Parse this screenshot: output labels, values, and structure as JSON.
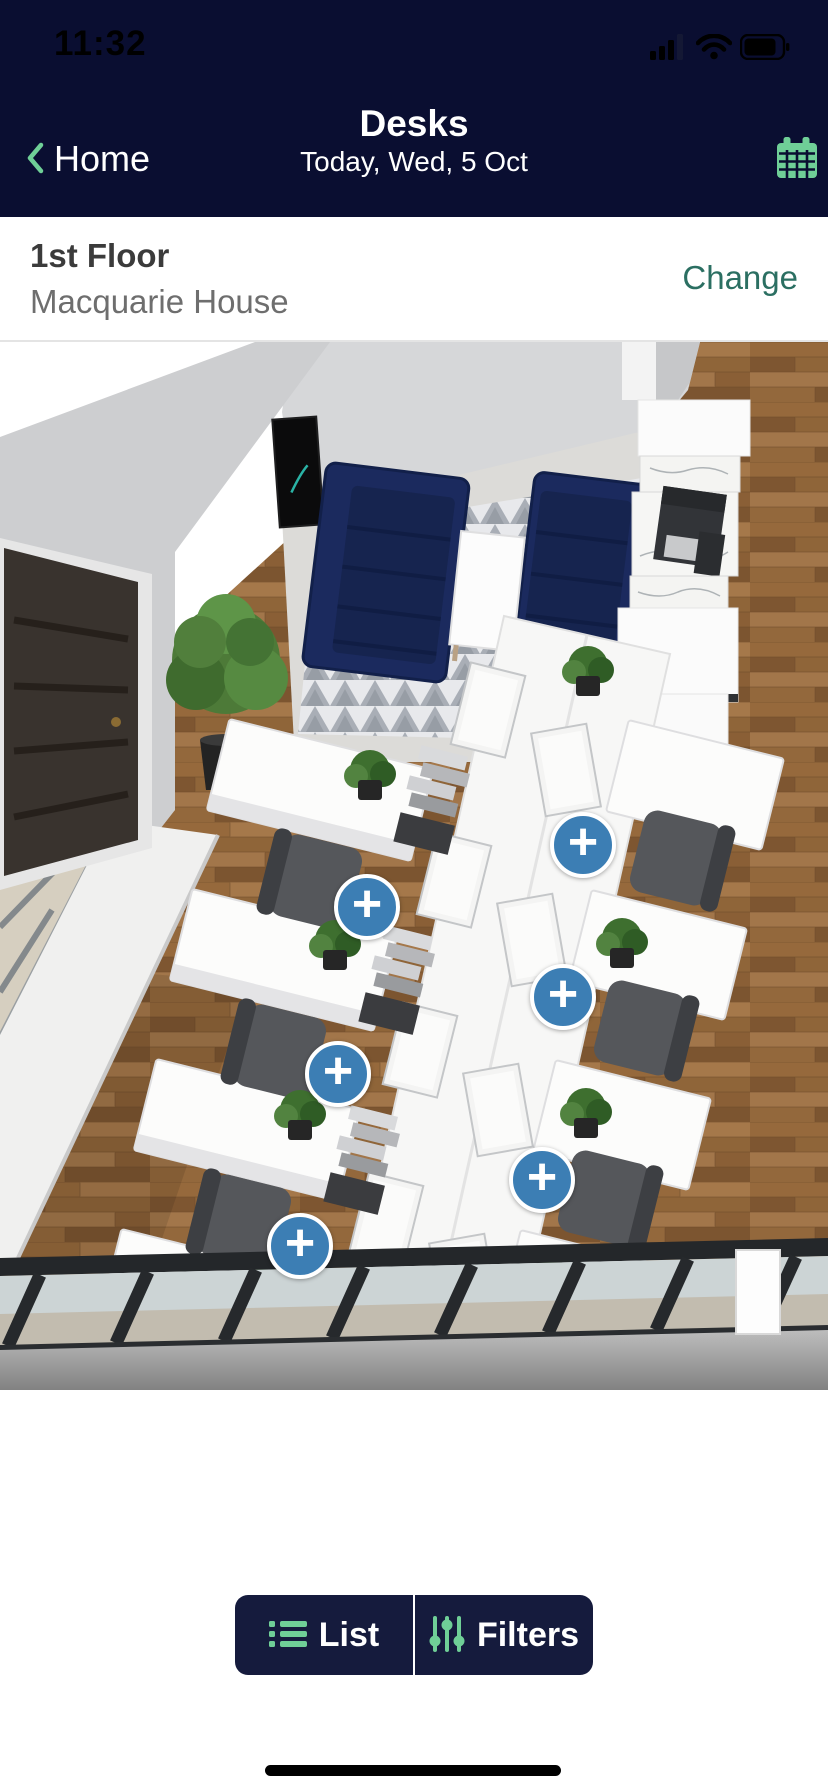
{
  "status_bar": {
    "time": "11:32"
  },
  "header": {
    "back_label": "Home",
    "title": "Desks",
    "subtitle": "Today, Wed, 5 Oct"
  },
  "location_bar": {
    "floor": "1st Floor",
    "building": "Macquarie House",
    "change_label": "Change"
  },
  "floorplan": {
    "marker_symbol": "+",
    "markers": [
      {
        "id": 1,
        "x": 583,
        "y": 503
      },
      {
        "id": 2,
        "x": 367,
        "y": 565
      },
      {
        "id": 3,
        "x": 563,
        "y": 655
      },
      {
        "id": 4,
        "x": 338,
        "y": 732
      },
      {
        "id": 5,
        "x": 542,
        "y": 838
      },
      {
        "id": 6,
        "x": 300,
        "y": 904
      }
    ]
  },
  "bottom_bar": {
    "list_label": "List",
    "filters_label": "Filters"
  },
  "colors": {
    "header_navy": "#0A0E31",
    "button_navy": "#151B3D",
    "accent_green": "#6FCF97",
    "link_teal": "#2B6F62",
    "marker_blue": "#3C7EB4"
  }
}
